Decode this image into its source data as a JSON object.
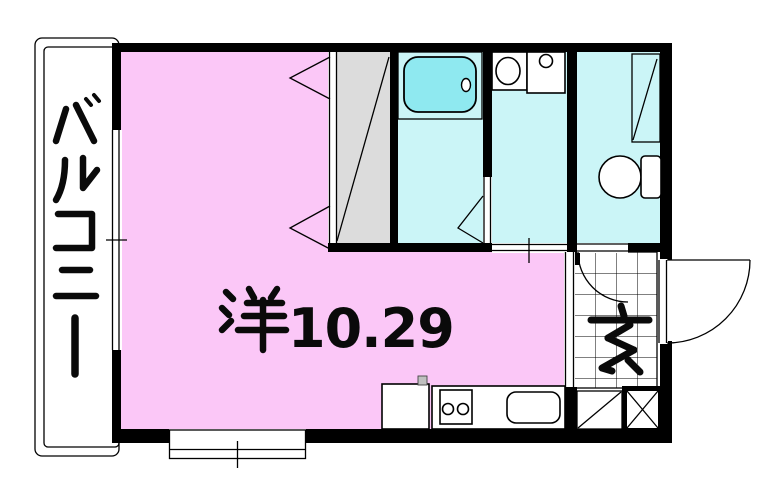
{
  "labels": {
    "balcony": "バルコニー",
    "room": "洋10.29",
    "room_kanji": "洋",
    "room_size": "10.29",
    "entrance": "玄"
  },
  "colors": {
    "wall": "#000000",
    "room_pink": "#FBC7F7",
    "wet_cyan": "#CBF5F7",
    "bathtub": "#8FE9F0",
    "closet_gray": "#DCDCDC",
    "background": "#FFFFFF"
  },
  "rooms": [
    {
      "id": "balcony",
      "label": "バルコニー",
      "type": "balcony"
    },
    {
      "id": "western-room",
      "label": "洋10.29",
      "type": "western-style-room",
      "size": "10.29"
    },
    {
      "id": "closet",
      "type": "closet",
      "fixtures": [
        "bifold-doors"
      ]
    },
    {
      "id": "bathroom",
      "type": "unit-bath",
      "fixtures": [
        "bathtub",
        "folding-door"
      ]
    },
    {
      "id": "washroom",
      "type": "washroom",
      "fixtures": [
        "washbasin",
        "washing-machine-pan",
        "sliding-door"
      ]
    },
    {
      "id": "toilet-room",
      "type": "toilet",
      "fixtures": [
        "toilet",
        "shelf"
      ]
    },
    {
      "id": "entrance",
      "label": "玄",
      "type": "genkan",
      "fixtures": [
        "tiled-floor",
        "entrance-door",
        "shoe-storage",
        "pipe-space"
      ]
    },
    {
      "id": "kitchen",
      "type": "kitchenette",
      "fixtures": [
        "refrigerator-space",
        "two-burner-stove",
        "kitchen-sink"
      ]
    }
  ]
}
